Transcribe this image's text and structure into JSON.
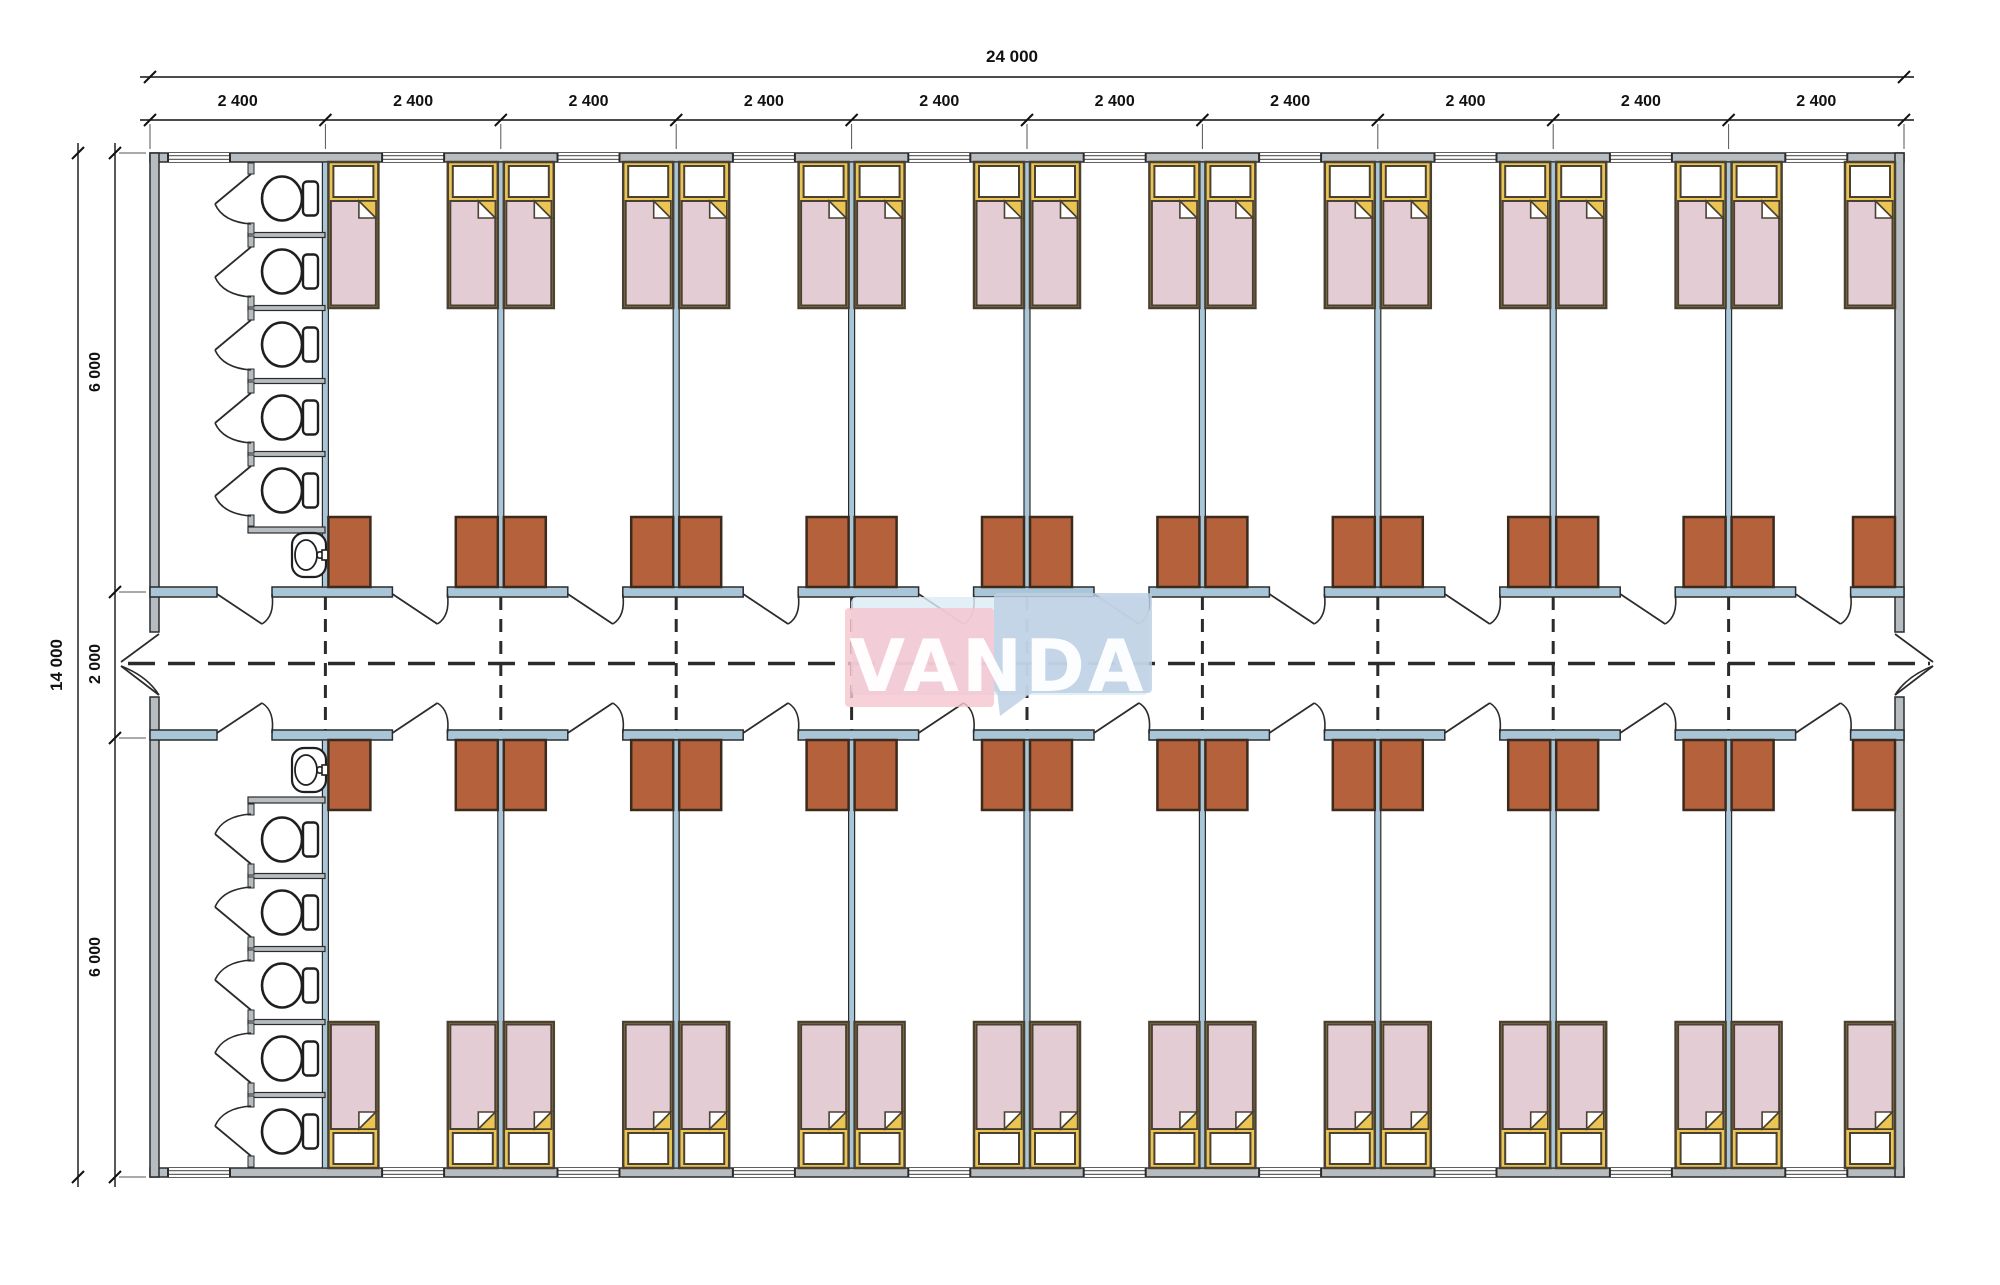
{
  "drawing": {
    "type": "dormitory-floor-plan",
    "bands": [
      "top-rooms",
      "corridor",
      "bottom-rooms"
    ]
  },
  "dimensions": {
    "overall_width": "24 000",
    "bay_width": "2 400",
    "bay_count": 10,
    "overall_height": "14 000",
    "top_band": "6 000",
    "corridor": "2 000",
    "bottom_band": "6 000"
  },
  "fixtures": {
    "rooms_per_band": 9,
    "beds_per_band": 18,
    "desks_per_band": 18,
    "toilet_stalls_per_band": 5,
    "sinks_per_band": 1
  },
  "watermark": {
    "text": "VANDA",
    "pink": "#f5c6cf",
    "blue": "#bdd0e4",
    "pale_blue": "#dcecf4",
    "text_color": "rgba(255,255,255,0.95)"
  },
  "colors": {
    "wall_fill": "#b6bcc0",
    "partition_fill": "#a9c6d8",
    "line": "#2b2b2b",
    "dim_color": "#111111",
    "bed_frame": "#eac553",
    "bed_border": "#4a4132",
    "blanket": "#e4ccd4",
    "pillow": "#ffffff",
    "desk_fill": "#b4613c",
    "desk_border": "#3c2b1d",
    "fixture_stroke": "#1f1f1f",
    "window_line": "#666666"
  }
}
